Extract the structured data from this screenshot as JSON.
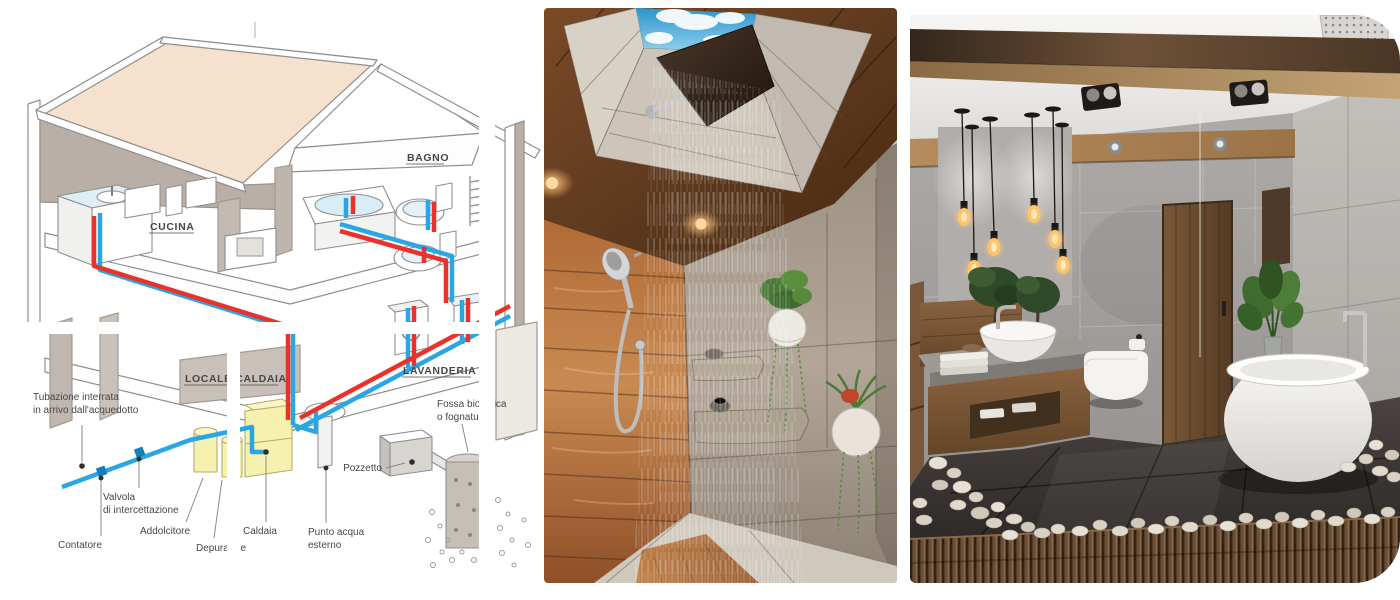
{
  "collage": {
    "panels": [
      {
        "id": "plumbing-diagram",
        "type": "diagram"
      },
      {
        "id": "wood-shower-photo",
        "type": "photo"
      },
      {
        "id": "modern-bathroom-photo",
        "type": "photo"
      }
    ]
  },
  "diagram": {
    "rooms": {
      "cucina": "CUCINA",
      "bagno": "BAGNO",
      "locale_caldaia": "LOCALE CALDAIA",
      "lavanderia": "LAVANDERIA"
    },
    "labels": {
      "tubazione": [
        "Tubazione interrata",
        "in arrivo dall'acquedotto"
      ],
      "contatore": "Contatore",
      "valvola": [
        "Valvola",
        "di intercettazione"
      ],
      "addolcitore": "Addolcitore",
      "depuratore": "Depuratore",
      "caldaia": "Caldaia",
      "punto_acqua": [
        "Punto acqua",
        "esterno"
      ],
      "pozzetto": "Pozzetto",
      "fossa": [
        "Fossa biologica",
        "o fognatura"
      ]
    },
    "colors": {
      "cold_water_pipe": "#2aa7e2",
      "hot_water_pipe": "#e8322a",
      "roof": "#f5e1cd",
      "walls": "#b9afa7",
      "appliances_yellow": "#f7f1b0",
      "label_text": "#474747"
    }
  },
  "photos": {
    "shower": {
      "palette": {
        "wood": "#a9652f",
        "sky": "#3aa3dc",
        "tile": "#a3988b"
      }
    },
    "bathroom": {
      "palette": {
        "concrete": "#a9a6a3",
        "beam": "#a5815a",
        "floor": "#3a3634",
        "deck": "#64492f",
        "tub": "#f5f4f2"
      }
    }
  }
}
